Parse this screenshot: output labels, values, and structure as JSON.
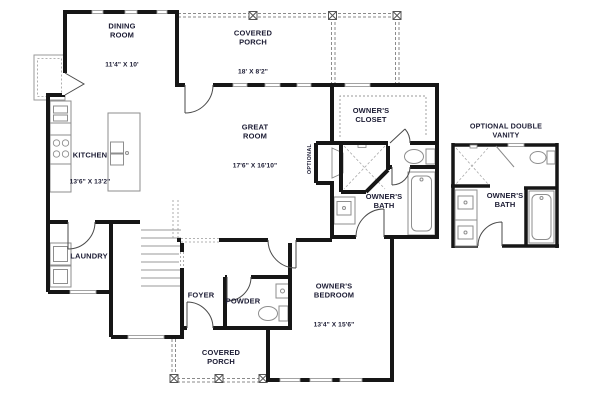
{
  "rooms": {
    "dining": {
      "name": "DINING\nROOM",
      "dims": "11'4\" X 10'"
    },
    "covered_porch_top": {
      "name": "COVERED\nPORCH",
      "dims": "18' X 8'2\""
    },
    "great_room": {
      "name": "GREAT\nROOM",
      "dims": "17'6\" X 16'10\""
    },
    "kitchen": {
      "name": "KITCHEN",
      "dims": "13'6\" X 13'2\""
    },
    "laundry": {
      "name": "LAUNDRY"
    },
    "foyer": {
      "name": "FOYER"
    },
    "powder": {
      "name": "POWDER"
    },
    "owners_closet": {
      "name": "OWNER'S\nCLOSET"
    },
    "owners_bath": {
      "name": "OWNER'S\nBATH"
    },
    "owners_bedroom": {
      "name": "OWNER'S\nBEDROOM",
      "dims": "13'4\" X 15'6\""
    },
    "covered_porch_bottom": {
      "name": "COVERED\nPORCH"
    }
  },
  "detail": {
    "title": "OPTIONAL DOUBLE VANITY",
    "room": {
      "name": "OWNER'S\nBATH"
    }
  },
  "annotations": {
    "fireplace": "OPTIONAL"
  },
  "colors": {
    "wall": "#161616",
    "text": "#1b1b33",
    "fixture": "#8e8e8e",
    "dashed": "#8a8a8a",
    "background": "#ffffff"
  }
}
